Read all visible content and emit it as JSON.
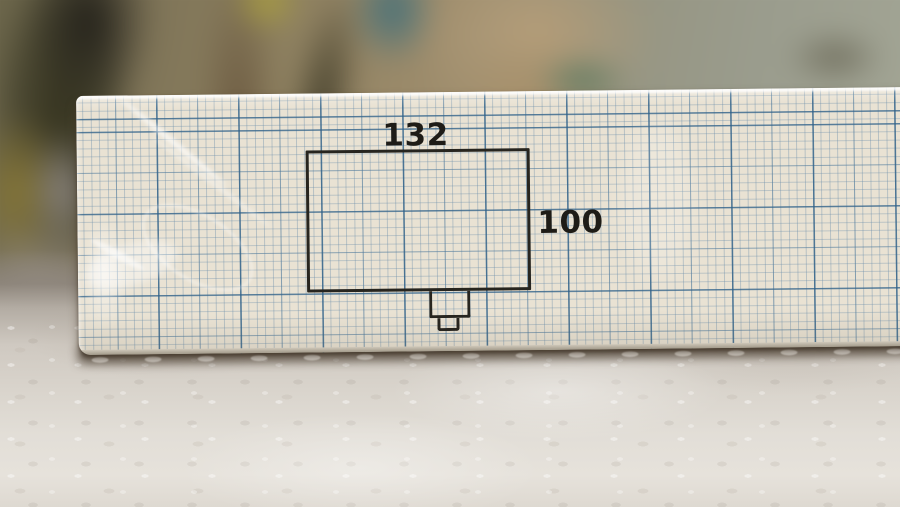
{
  "diagram": {
    "width_label": "132",
    "height_label": "100"
  },
  "colors": {
    "paper": "#e9e2d3",
    "grid_minor": "#8fb0c4",
    "grid_medium": "#467396",
    "grid_major": "#2d5f87",
    "ink": "#25231d",
    "plaster_surface": "#e2ded7",
    "cast_shadow": "#4e4337",
    "background_olive": "#7d7357",
    "background_tan": "#b59d78",
    "background_teal": "#44707a"
  }
}
